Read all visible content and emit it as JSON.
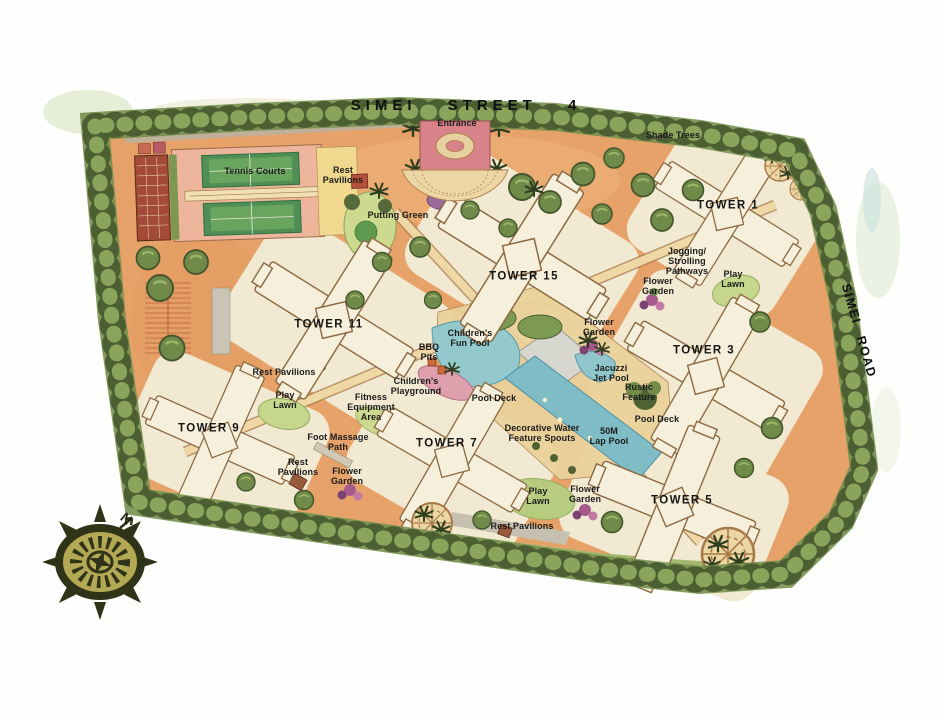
{
  "title": {
    "street": "SIMEI STREET 4"
  },
  "road": {
    "name": "SIMEI ROAD"
  },
  "compass": {
    "north": "N"
  },
  "towers": {
    "tower1": "TOWER 1",
    "tower3": "TOWER 3",
    "tower5": "TOWER 5",
    "tower7": "TOWER 7",
    "tower9": "TOWER 9",
    "tower11": "TOWER 11",
    "tower15": "TOWER 15"
  },
  "labels": {
    "entrance": "Entrance",
    "shade_trees": "Shade Trees",
    "tennis_courts": "Tennis Courts",
    "rest_pavilions_north": "Rest\nPavilions",
    "putting_green": "Putting Green",
    "jogging_strolling_pathways": "Jogging/\nStrolling\nPathways",
    "play_lawn_east": "Play\nLawn",
    "flower_garden_east": "Flower\nGarden",
    "flower_garden_center": "Flower\nGarden",
    "childrens_fun_pool": "Children's\nFun Pool",
    "bbq_pits": "BBQ\nPits",
    "rest_pavilions_west": "Rest Pavilions",
    "childrens_playground": "Children's\nPlayground",
    "play_lawn_west": "Play\nLawn",
    "fitness_equipment_area": "Fitness\nEquipment\nArea",
    "jacuzzi_jet_pool": "Jacuzzi\nJet Pool",
    "rustic_feature": "Rustic\nFeature",
    "pool_deck_west": "Pool Deck",
    "pool_deck_east": "Pool Deck",
    "foot_massage_path": "Foot Massage\nPath",
    "decorative_water_feature_spouts": "Decorative Water\nFeature Spouts",
    "lap_pool": "50M\nLap Pool",
    "rest_pavilions_southwest": "Rest\nPavilions",
    "flower_garden_southwest": "Flower\nGarden",
    "play_lawn_south": "Play\nLawn",
    "flower_garden_south": "Flower\nGarden",
    "rest_pavilions_south": "Rest Pavilions"
  },
  "colors": {
    "site_orange": "#E6A268",
    "building_cream": "#F5EEDA",
    "tree_dark": "#4C5F33",
    "tree_light": "#8AA45C",
    "pool_water": "#7FBCC6",
    "tennis_green": "#4F8F55",
    "entrance_pink": "#D8828A",
    "deck_gray": "#D7D7CF",
    "path_tan": "#EFD8A6",
    "compass_khaki": "#B3A854"
  }
}
